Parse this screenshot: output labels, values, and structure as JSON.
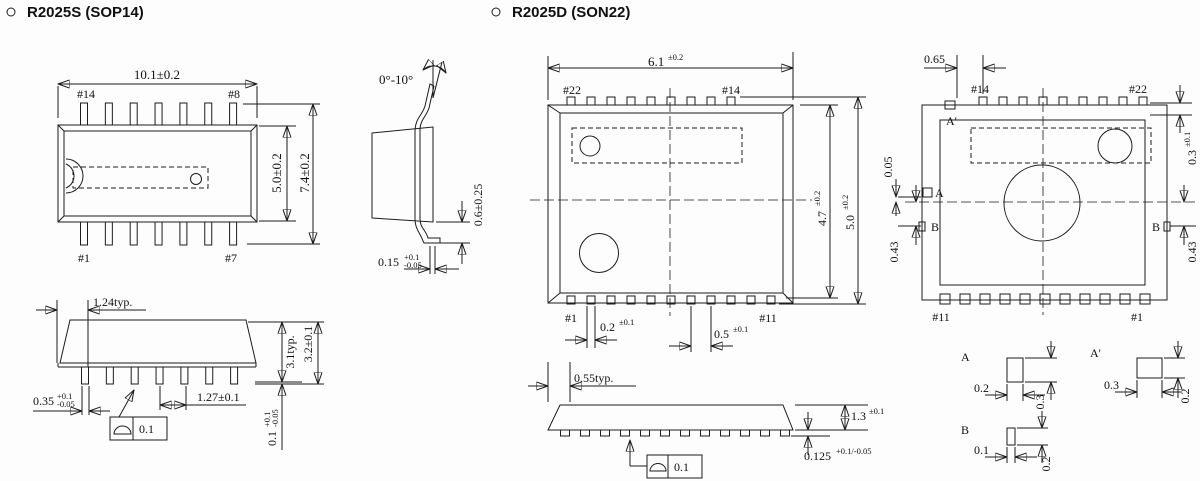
{
  "titles": {
    "left": "R2025S (SOP14)",
    "right": "R2025D (SON22)"
  },
  "sop14": {
    "top": {
      "dim_width": "10.1±0.2",
      "pin_tl": "#14",
      "pin_tr": "#8",
      "pin_bl": "#1",
      "pin_br": "#7",
      "dim_body": "5.0±0.2",
      "dim_overall": "7.4±0.2"
    },
    "side": {
      "angle": "0°-10°",
      "dim_foot": "0.6±0.25",
      "thk": {
        "v": "0.15",
        "sup": "+0.1",
        "sub": "-0.05"
      }
    },
    "front": {
      "dim_edge": "1.24typ.",
      "lead_w": {
        "v": "0.35",
        "sup": "+0.1",
        "sub": "-0.05"
      },
      "dim_pitch": "1.27±0.1",
      "dim_body_h": "3.1typ.",
      "dim_overall_h": "3.2±0.1",
      "standoff": {
        "v": "0.1",
        "sup": "+0.1",
        "sub": "-0.05"
      },
      "flatness": "0.1"
    }
  },
  "son22": {
    "top": {
      "dim_width": {
        "v": "6.1",
        "t": "±0.2"
      },
      "pin_tl": "#22",
      "pin_tr": "#14",
      "pin_bl": "#1",
      "pin_br": "#11",
      "pad_w": {
        "v": "0.2",
        "t": "±0.1"
      },
      "pad_pitch": {
        "v": "0.5",
        "t": "±0.1"
      },
      "dim_body": {
        "v": "4.7",
        "t": "±0.2"
      },
      "dim_overall": {
        "v": "5.0",
        "t": "±0.2"
      }
    },
    "side": {
      "dim_edge": "0.55typ.",
      "dim_h": {
        "v": "1.3",
        "t": "±0.1"
      },
      "pad_thk": {
        "v": "0.125",
        "t": "+0.1/-0.05"
      },
      "flatness": "0.1"
    },
    "bottom": {
      "dim_edge": "0.65",
      "pin_tl": "#14",
      "pin_tr": "#22",
      "pin_bl": "#11",
      "pin_br": "#1",
      "dim_offset": "0.05",
      "dim_b_left": "0.43",
      "dim_b_right": "0.43",
      "dim_top_pad": {
        "v": "0.3",
        "t": "±0.1"
      },
      "label_a": "A",
      "label_a2": "A'",
      "label_b1": "B",
      "label_b2": "B"
    },
    "details": {
      "a": {
        "label": "A",
        "w": "0.2",
        "h": "0.3"
      },
      "a2": {
        "label": "A'",
        "w": "0.3",
        "h": "0.2"
      },
      "b": {
        "label": "B",
        "w": "0.1",
        "h": "0.2"
      }
    }
  }
}
